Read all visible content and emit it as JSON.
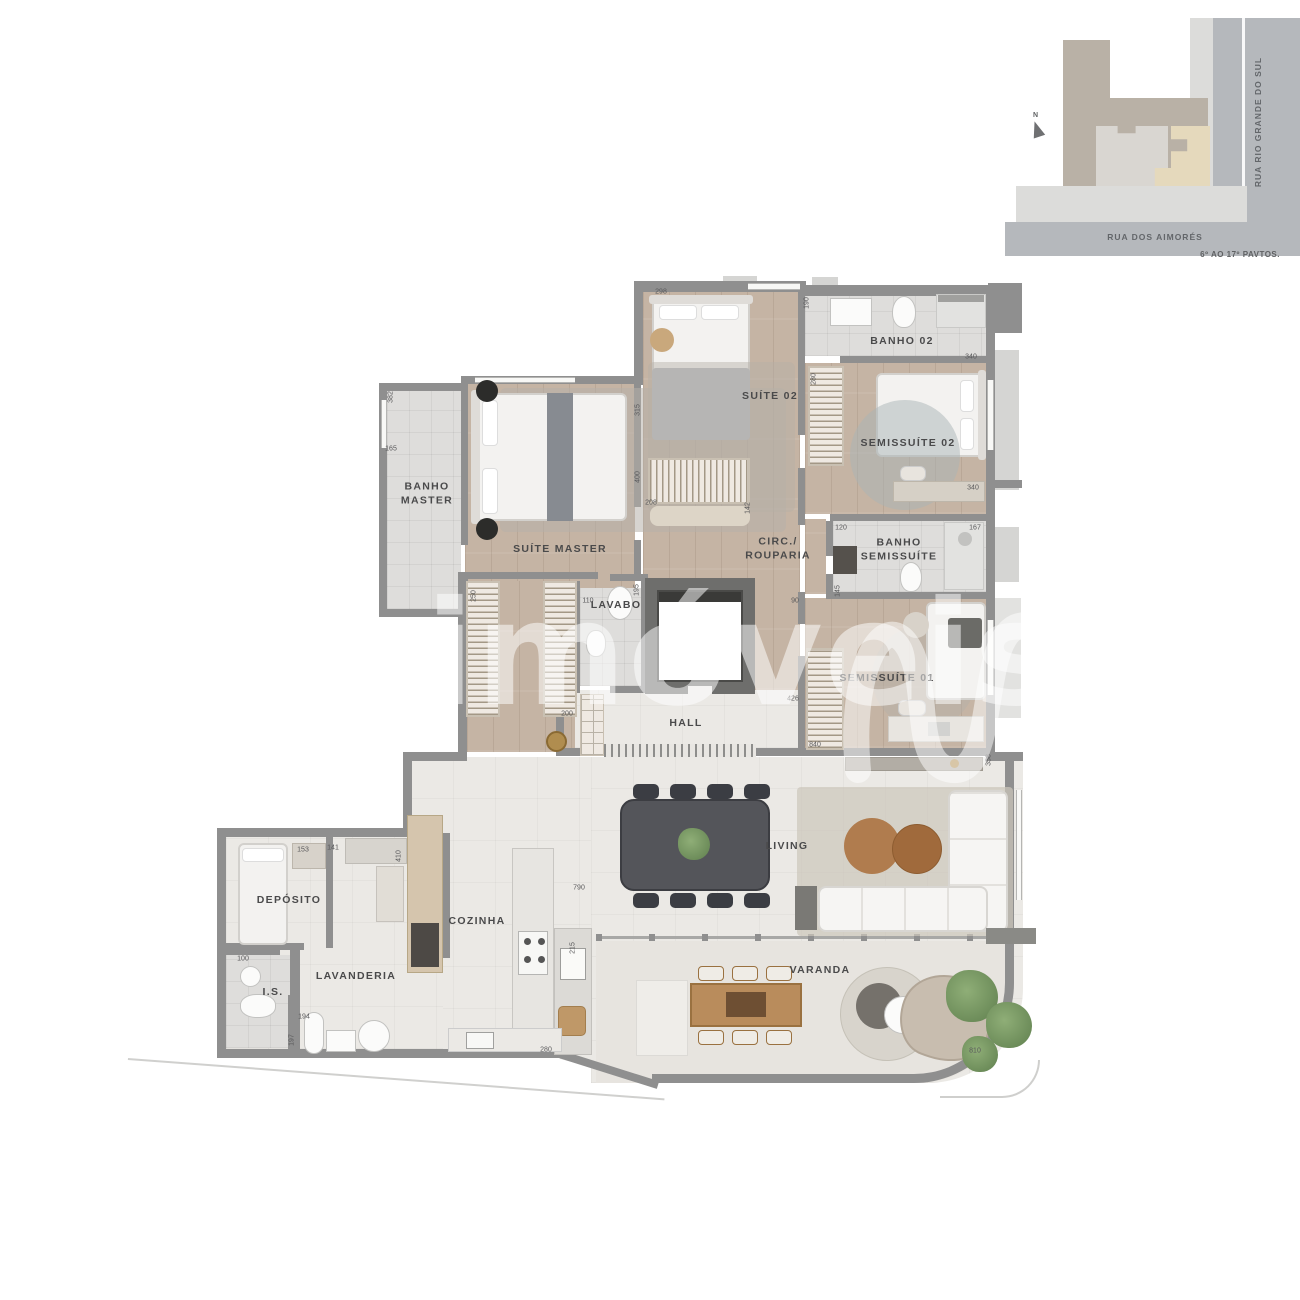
{
  "watermark": {
    "text": "imóveis"
  },
  "site_map": {
    "north_label": "N",
    "street_right": "RUA RIO GRANDE DO SUL",
    "street_bottom": "RUA DOS AIMORÉS",
    "caption": "6º AO 17º PAVTOS."
  },
  "rooms": {
    "banho_master": {
      "label": "BANHO\nMASTER"
    },
    "suite_master": {
      "label": "SUÍTE MASTER"
    },
    "suite_02": {
      "label": "SUÍTE 02"
    },
    "banho_02": {
      "label": "BANHO 02"
    },
    "semissuite_02": {
      "label": "SEMISSUÍTE 02"
    },
    "circ_rouparia": {
      "label": "CIRC./\nROUPARIA"
    },
    "banho_semissuite": {
      "label": "BANHO\nSEMISSUÍTE"
    },
    "semissuite_01": {
      "label": "SEMISSUÍTE 01"
    },
    "lavabo": {
      "label": "LAVABO"
    },
    "hall": {
      "label": "HALL"
    },
    "deposito": {
      "label": "DEPÓSITO"
    },
    "is": {
      "label": "I.S."
    },
    "lavanderia": {
      "label": "LAVANDERIA"
    },
    "cozinha": {
      "label": "COZINHA"
    },
    "living": {
      "label": "LIVING"
    },
    "varanda": {
      "label": "VARANDA"
    }
  },
  "dims": [
    "298",
    "190",
    "340",
    "382",
    "165",
    "315",
    "400",
    "280",
    "340",
    "208",
    "142",
    "120",
    "167",
    "145",
    "90",
    "110",
    "195",
    "250",
    "200",
    "426",
    "840",
    "358",
    "153",
    "141",
    "410",
    "100",
    "194",
    "197",
    "790",
    "215",
    "280",
    "810"
  ],
  "colors": {
    "wall": "#8f8f8f",
    "wood_floor": "#c5b4a4",
    "bath_floor": "#dedddb",
    "stone_floor": "#ebe9e5",
    "map_street": "#b5b8bc",
    "map_sidewalk": "#dcdcda",
    "map_lot": "#b9b1a6",
    "map_building": "#d9d6d1",
    "map_unit_highlight": "#e5d9bc"
  }
}
